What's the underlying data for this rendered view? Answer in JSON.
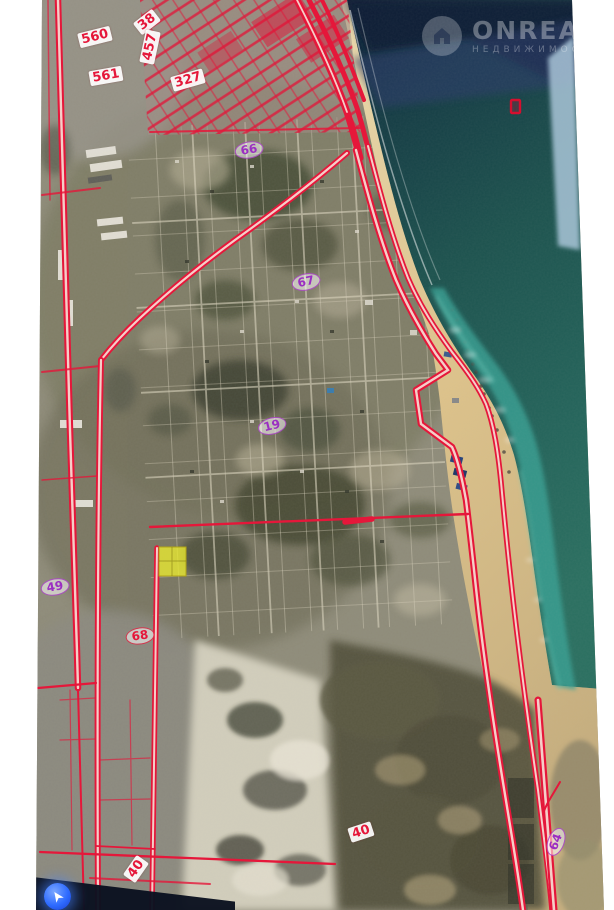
{
  "watermark": {
    "brand": "ONREALT",
    "subtitle": "НЕДВИЖИМОСТЬ",
    "logo": "house-in-circle-icon"
  },
  "map": {
    "kind": "satellite-cadastral-photo",
    "parcel_labels": [
      {
        "text": "560",
        "x": 95,
        "y": 37,
        "rot": -14,
        "style": "box"
      },
      {
        "text": "561",
        "x": 106,
        "y": 76,
        "rot": -10,
        "style": "box"
      },
      {
        "text": "38",
        "x": 147,
        "y": 22,
        "rot": -38,
        "style": "box"
      },
      {
        "text": "457",
        "x": 150,
        "y": 47,
        "rot": -78,
        "style": "box"
      },
      {
        "text": "327",
        "x": 188,
        "y": 80,
        "rot": -16,
        "style": "box"
      },
      {
        "text": "66",
        "x": 249,
        "y": 150,
        "rot": -10,
        "style": "oval"
      },
      {
        "text": "67",
        "x": 306,
        "y": 282,
        "rot": -12,
        "style": "oval"
      },
      {
        "text": "19",
        "x": 272,
        "y": 426,
        "rot": -14,
        "style": "oval"
      },
      {
        "text": "49",
        "x": 55,
        "y": 587,
        "rot": -10,
        "style": "oval"
      },
      {
        "text": "68",
        "x": 140,
        "y": 636,
        "rot": -8,
        "style": "oval-red"
      },
      {
        "text": "40",
        "x": 361,
        "y": 832,
        "rot": -18,
        "style": "box"
      },
      {
        "text": "40",
        "x": 136,
        "y": 869,
        "rot": -55,
        "style": "box"
      },
      {
        "text": "64",
        "x": 556,
        "y": 842,
        "rot": -70,
        "style": "oval"
      }
    ],
    "colors": {
      "cadastral_red": "#e5173a",
      "highlight_yellow": "#e8e832",
      "label_purple": "#9b2fc2",
      "sea_deep": "#0e1f38",
      "sea_teal": "#1c524e",
      "shallow_turquoise": "#39a093",
      "beach_sand": "#e0c890",
      "location_blue": "#2e6bff",
      "watermark_white": "rgba(255,255,255,0.33)"
    }
  }
}
